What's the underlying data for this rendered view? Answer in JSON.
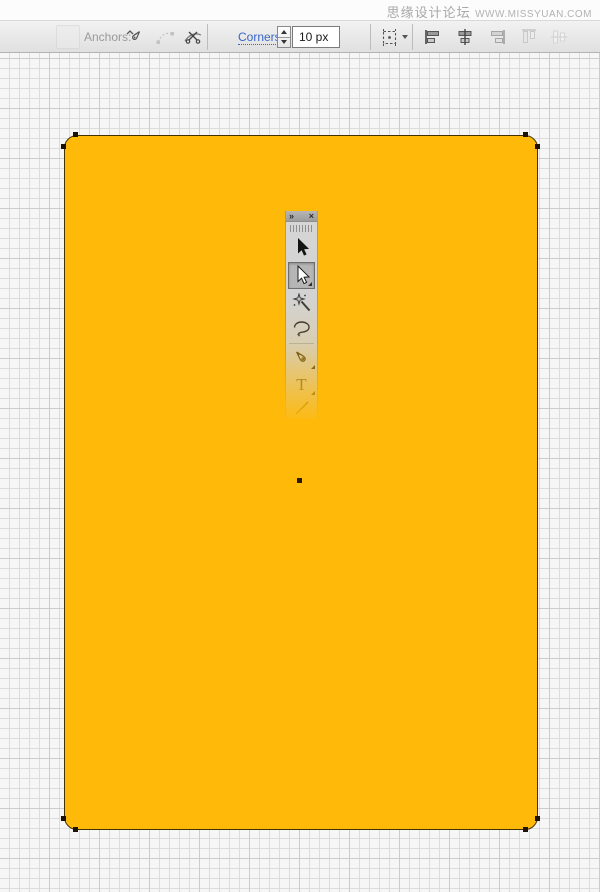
{
  "watermark": {
    "site_name": "思缘设计论坛",
    "site_url": "WWW.MISSYUAN.COM"
  },
  "control_bar": {
    "anchors_label": "Anchors:",
    "corners_label": "Corners:",
    "corners_value": "10 px",
    "anchor_tools": [
      "convert-anchor",
      "show-handles",
      "cut-path"
    ],
    "align_tools": [
      "horizontal-align-left",
      "horizontal-align-center",
      "horizontal-align-right",
      "vertical-align-top",
      "vertical-align-center"
    ]
  },
  "tool_palette": {
    "collapse_glyph": "»",
    "close_glyph": "×",
    "type_tool_glyph": "T",
    "tools": [
      {
        "name": "selection-tool",
        "selected": false
      },
      {
        "name": "direct-selection-tool",
        "selected": true
      },
      {
        "name": "magic-wand-tool",
        "selected": false
      },
      {
        "name": "lasso-tool",
        "selected": false
      },
      {
        "name": "pen-tool",
        "selected": false
      },
      {
        "name": "type-tool",
        "selected": false
      },
      {
        "name": "line-segment-tool",
        "selected": false
      }
    ]
  },
  "canvas": {
    "shape": {
      "fill": "#FFB908",
      "stroke": "#443300",
      "corner_radius": "10 px",
      "anchor_count": 8
    },
    "grid": {
      "cell_px": 10,
      "minor_color": "#dcdcdc",
      "major_color": "#cccccc",
      "background": "#f6f6f6"
    }
  },
  "colors": {
    "accent_link": "#3a66c9",
    "toolbar_bg": "#e8e8e8",
    "watermark_gray": "#a8a8a8"
  }
}
